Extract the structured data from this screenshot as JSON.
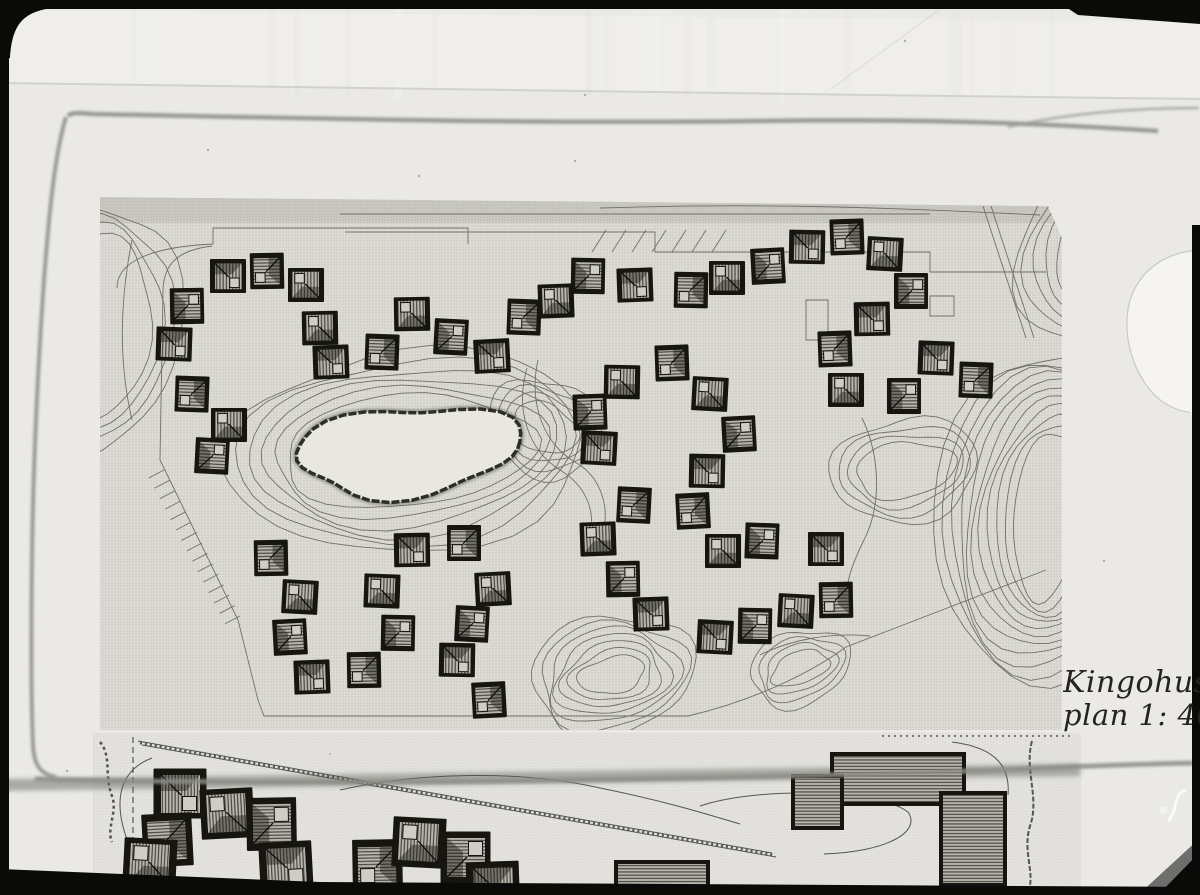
{
  "caption": {
    "line1": "Kingohuse",
    "line2": "plan 1: 40"
  },
  "colors": {
    "paper": "#eae9e6",
    "paper_top": "#efeeea",
    "sheet_edge": "#d2d1cc",
    "plan_bg": "#dcdbd5",
    "plan_dot": "#c7c6bf",
    "contour": "#6b6a63",
    "house_dark": "#16150f",
    "house_hatch_bg": "#b7b6ae",
    "house_hatch_line": "#413f38",
    "courtyard": "#cfcec6",
    "pond_fill": "#e8e7e1",
    "pond_rim": "#2e2d28",
    "pencil": "#8e8d88",
    "road_band": "#95948e",
    "frame_black": "#0a0a09",
    "blob_white": "#f5f4f0",
    "caption_ink": "#24231e"
  },
  "upper_plan": {
    "poly": "M100,197 L1048,206 L1062,238 L1062,730 L100,730 Z",
    "top_strip": {
      "x": 100,
      "y": 197,
      "w": 962,
      "h": 26
    },
    "house_size": 34,
    "houses": [
      [
        228,
        277,
        0
      ],
      [
        266,
        271,
        1
      ],
      [
        306,
        284,
        2
      ],
      [
        188,
        306,
        3
      ],
      [
        174,
        345,
        0
      ],
      [
        191,
        394,
        1
      ],
      [
        229,
        424,
        2
      ],
      [
        213,
        456,
        3
      ],
      [
        320,
        327,
        2
      ],
      [
        331,
        363,
        0
      ],
      [
        381,
        352,
        1
      ],
      [
        412,
        313,
        2
      ],
      [
        452,
        337,
        3
      ],
      [
        492,
        357,
        0
      ],
      [
        523,
        317,
        1
      ],
      [
        556,
        300,
        2
      ],
      [
        589,
        276,
        3
      ],
      [
        635,
        286,
        0
      ],
      [
        690,
        290,
        1
      ],
      [
        727,
        277,
        2
      ],
      [
        769,
        266,
        3
      ],
      [
        807,
        248,
        0
      ],
      [
        846,
        237,
        1
      ],
      [
        885,
        253,
        2
      ],
      [
        912,
        291,
        3
      ],
      [
        872,
        320,
        0
      ],
      [
        834,
        349,
        1
      ],
      [
        846,
        389,
        2
      ],
      [
        905,
        396,
        3
      ],
      [
        936,
        359,
        0
      ],
      [
        975,
        380,
        1
      ],
      [
        622,
        381,
        2
      ],
      [
        591,
        412,
        3
      ],
      [
        599,
        449,
        0
      ],
      [
        633,
        505,
        1
      ],
      [
        598,
        538,
        2
      ],
      [
        624,
        579,
        3
      ],
      [
        651,
        615,
        0
      ],
      [
        671,
        363,
        1
      ],
      [
        710,
        393,
        2
      ],
      [
        740,
        434,
        3
      ],
      [
        707,
        472,
        0
      ],
      [
        692,
        511,
        1
      ],
      [
        723,
        550,
        2
      ],
      [
        763,
        541,
        3
      ],
      [
        826,
        550,
        0
      ],
      [
        835,
        600,
        1
      ],
      [
        796,
        610,
        2
      ],
      [
        756,
        626,
        3
      ],
      [
        715,
        638,
        0
      ],
      [
        270,
        558,
        1
      ],
      [
        300,
        596,
        2
      ],
      [
        291,
        637,
        3
      ],
      [
        312,
        678,
        0
      ],
      [
        363,
        670,
        1
      ],
      [
        382,
        590,
        2
      ],
      [
        399,
        633,
        3
      ],
      [
        412,
        551,
        0
      ],
      [
        463,
        543,
        1
      ],
      [
        493,
        588,
        2
      ],
      [
        473,
        624,
        3
      ],
      [
        457,
        661,
        0
      ],
      [
        488,
        700,
        1
      ]
    ],
    "pond": {
      "cx": 408,
      "cy": 451,
      "rx": 112,
      "ry": 44,
      "rot": -5
    },
    "ring_systems": [
      {
        "cx": 408,
        "cy": 451,
        "rx": 126,
        "ry": 56,
        "rot": -5,
        "n": 6,
        "gx": 11,
        "gy": 9,
        "wob": 0.05,
        "seed": 1
      },
      {
        "cx": 545,
        "cy": 428,
        "rx": 34,
        "ry": 24,
        "rot": 25,
        "n": 4,
        "gx": 8,
        "gy": 8,
        "wob": 0.07,
        "seed": 2
      },
      {
        "cx": 1048,
        "cy": 515,
        "rx": 34,
        "ry": 85,
        "rot": 6,
        "n": 11,
        "gx": 8,
        "gy": 8,
        "wob": 0.04,
        "seed": 3
      },
      {
        "cx": 612,
        "cy": 675,
        "rx": 34,
        "ry": 18,
        "rot": -12,
        "n": 7,
        "gx": 8,
        "gy": 7,
        "wob": 0.08,
        "seed": 4
      },
      {
        "cx": 1105,
        "cy": 240,
        "rx": 40,
        "ry": 70,
        "rot": 30,
        "n": 5,
        "gx": 10,
        "gy": 10,
        "wob": 0.05,
        "seed": 5
      },
      {
        "cx": 800,
        "cy": 668,
        "rx": 30,
        "ry": 16,
        "rot": -20,
        "n": 4,
        "gx": 7,
        "gy": 7,
        "wob": 0.08,
        "seed": 6
      },
      {
        "cx": 95,
        "cy": 330,
        "rx": 55,
        "ry": 95,
        "rot": 10,
        "n": 4,
        "gx": 10,
        "gy": 10,
        "wob": 0.05,
        "seed": 7
      },
      {
        "cx": 905,
        "cy": 470,
        "rx": 50,
        "ry": 28,
        "rot": -8,
        "n": 4,
        "gx": 8,
        "gy": 8,
        "wob": 0.07,
        "seed": 8
      }
    ],
    "flow_paths": [
      "M527,368 C515,410 528,450 560,470 C585,485 596,510 590,535",
      "M538,360 C528,405 545,445 575,462 C600,476 610,505 603,533",
      "M862,418 C880,455 882,505 864,540 C850,568 842,592 848,618",
      "M760,655 C790,640 830,632 870,636",
      "M340,214 L930,214",
      "M600,208 C760,203 880,207 1040,215",
      "M117,288 C117,262 150,247 213,244 L213,228 L468,228 L468,244",
      "M345,232 L655,232 L655,252 L930,252 L930,272 L1046,272",
      "M983,206 L1026,338",
      "M991,206 L1034,338",
      "M160,460 L238,620 L258,700 L264,716 L688,716 C756,700 812,672 846,647 L1046,570",
      "M160,460 L163,292 C163,262 180,250 212,246",
      "M806,300 h22 v40 h-22 Z",
      "M930,296 h24 v20 h-24 Z",
      "M132,240 C120,300 118,360 132,420"
    ],
    "hatch_line": {
      "x1": 164,
      "y1": 470,
      "x2": 240,
      "y2": 616,
      "n": 15,
      "len": 17
    },
    "parking": {
      "x": 592,
      "y": 252,
      "n": 7,
      "dx": 20,
      "len": 22
    }
  },
  "lower_plan": {
    "bg": {
      "x": 93,
      "y": 733,
      "w": 988,
      "h": 162
    },
    "house_size": 50,
    "houses": [
      [
        180,
        795,
        0
      ],
      [
        166,
        840,
        1
      ],
      [
        227,
        812,
        2
      ],
      [
        273,
        824,
        3
      ],
      [
        286,
        868,
        0
      ],
      [
        376,
        866,
        1
      ],
      [
        419,
        841,
        2
      ],
      [
        467,
        858,
        3
      ],
      [
        493,
        888,
        0
      ],
      [
        150,
        862,
        2
      ]
    ],
    "buildings": [
      [
        832,
        754,
        132,
        50
      ],
      [
        793,
        776,
        49,
        52
      ],
      [
        941,
        793,
        64,
        92
      ],
      [
        616,
        862,
        92,
        28
      ]
    ],
    "road_band": "M0,779 L1080,764 L1080,776 L0,791 Z",
    "paths": [
      {
        "d": "M138,741 L772,853",
        "w": 1,
        "dash": ""
      },
      {
        "d": "M142,745 L776,857",
        "w": 1,
        "dash": ""
      },
      {
        "d": "M140,743 L774,855",
        "w": 2.5,
        "dash": "2,3"
      },
      {
        "d": "M133,737 L133,872",
        "w": 1.2,
        "dash": "6,4"
      },
      {
        "d": "M152,758 C120,770 112,800 128,842",
        "w": 1,
        "dash": ""
      },
      {
        "d": "M340,790 C420,772 520,770 600,788 C660,800 700,812 740,824",
        "w": 1,
        "dash": ""
      },
      {
        "d": "M700,806 C760,786 880,790 908,812 C922,832 886,852 824,854",
        "w": 1,
        "dash": ""
      },
      {
        "d": "M952,742 C1000,748 1010,770 1008,795",
        "w": 1,
        "dash": ""
      },
      {
        "d": "M882,736 L1072,736",
        "w": 1.5,
        "dash": "2,4"
      },
      {
        "d": "M1032,741 C1024,770 1040,798 1030,826 C1022,852 1036,874 1028,892",
        "w": 2,
        "dash": "5,2"
      },
      {
        "d": "M100,742 C112,756 104,776 112,796 C118,812 106,828 112,842",
        "w": 2.5,
        "dash": "3,3"
      }
    ],
    "white_scratch": "M1168,822 C1180,805 1172,795 1186,790"
  },
  "pencil": {
    "top": "M68,116 C72,112 80,113 92,114 C300,118 520,124 760,121 C950,118 1080,126 1158,131",
    "top2": "M1008,127 C1060,115 1120,108 1199,108",
    "left": "M66,117 C56,150 50,200 44,280 C37,380 33,470 32,560 C31,640 31,700 33,745 C34,765 40,774 56,777",
    "bottom": "M35,779 C300,786 700,780 1000,770 C1080,766 1150,764 1193,763"
  },
  "paper": {
    "sheet_edge": "M0,83 C400,90 800,94 1200,99",
    "sheet_poly": "M0,10 L1200,22 L1200,99 C800,94 400,90 0,83 Z",
    "crease": "M940,9 L831,89",
    "specks": [
      [
        575,
        161
      ],
      [
        905,
        41
      ],
      [
        419,
        176
      ],
      [
        1104,
        561
      ],
      [
        330,
        754
      ],
      [
        67,
        771
      ],
      [
        585,
        95
      ],
      [
        208,
        150
      ],
      [
        1180,
        680
      ],
      [
        365,
        580
      ]
    ]
  },
  "blob": {
    "body": "M1200,250 C1165,252 1140,270 1130,300 C1122,330 1130,365 1150,390 C1165,408 1185,414 1200,412 Z",
    "notch": "M1188,408 L1200,412 L1200,432 Z"
  },
  "frame": {
    "top_rect": [
      0,
      0,
      1200,
      9
    ],
    "top_right_wedge": "M1055,0 L1200,0 L1200,24 L1078,15 Z",
    "top_left_corner": "M0,9 L46,9 C22,14 12,26 10,58 L0,60 Z",
    "left_rect": [
      0,
      55,
      9,
      840
    ],
    "bottom_poly": "M0,869 L320,882 L1200,887 L1200,895 L0,895 Z",
    "right_rect": [
      1192,
      225,
      8,
      670
    ],
    "br_tri1": "M1200,838 L1200,895 L1138,895 Z",
    "br_tri2": "M1200,852 L1200,895 L1158,895 Z"
  }
}
